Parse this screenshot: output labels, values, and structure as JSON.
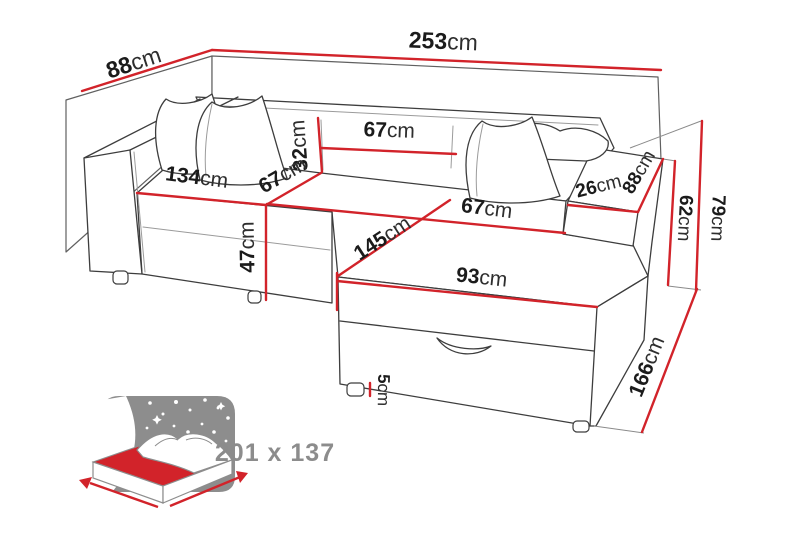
{
  "units": "cm",
  "colors": {
    "dimension_red": "#d2232a",
    "outline_gray": "#3d3d3d",
    "label_dark": "#1b1b1b",
    "icon_gray": "#8d8d8d",
    "background": "#ffffff"
  },
  "icon": {
    "name": "sleeping-function-bed-icon"
  },
  "dims": [
    {
      "id": "depth-total",
      "v": "88",
      "u": "cm"
    },
    {
      "id": "width-total",
      "v": "253",
      "u": "cm"
    },
    {
      "id": "backrest-cushion-height",
      "v": "32",
      "u": "cm"
    },
    {
      "id": "backrest-cushion-width",
      "v": "67",
      "u": "cm"
    },
    {
      "id": "seat-width-left",
      "v": "134",
      "u": "cm"
    },
    {
      "id": "seat-depth-left",
      "v": "67",
      "u": "cm"
    },
    {
      "id": "armrest-width",
      "v": "26",
      "u": "cm"
    },
    {
      "id": "armrest-depth",
      "v": "88",
      "u": "cm"
    },
    {
      "id": "armrest-height",
      "v": "62",
      "u": "cm"
    },
    {
      "id": "back-height",
      "v": "79",
      "u": "cm"
    },
    {
      "id": "seat-height",
      "v": "47",
      "u": "cm"
    },
    {
      "id": "chaise-length",
      "v": "145",
      "u": "cm"
    },
    {
      "id": "seat-width-right",
      "v": "67",
      "u": "cm"
    },
    {
      "id": "chaise-width",
      "v": "93",
      "u": "cm"
    },
    {
      "id": "side-length",
      "v": "166",
      "u": "cm"
    },
    {
      "id": "leg-height",
      "v": "5",
      "u": "cm"
    }
  ],
  "sleeping": {
    "label": "201 x 137"
  }
}
